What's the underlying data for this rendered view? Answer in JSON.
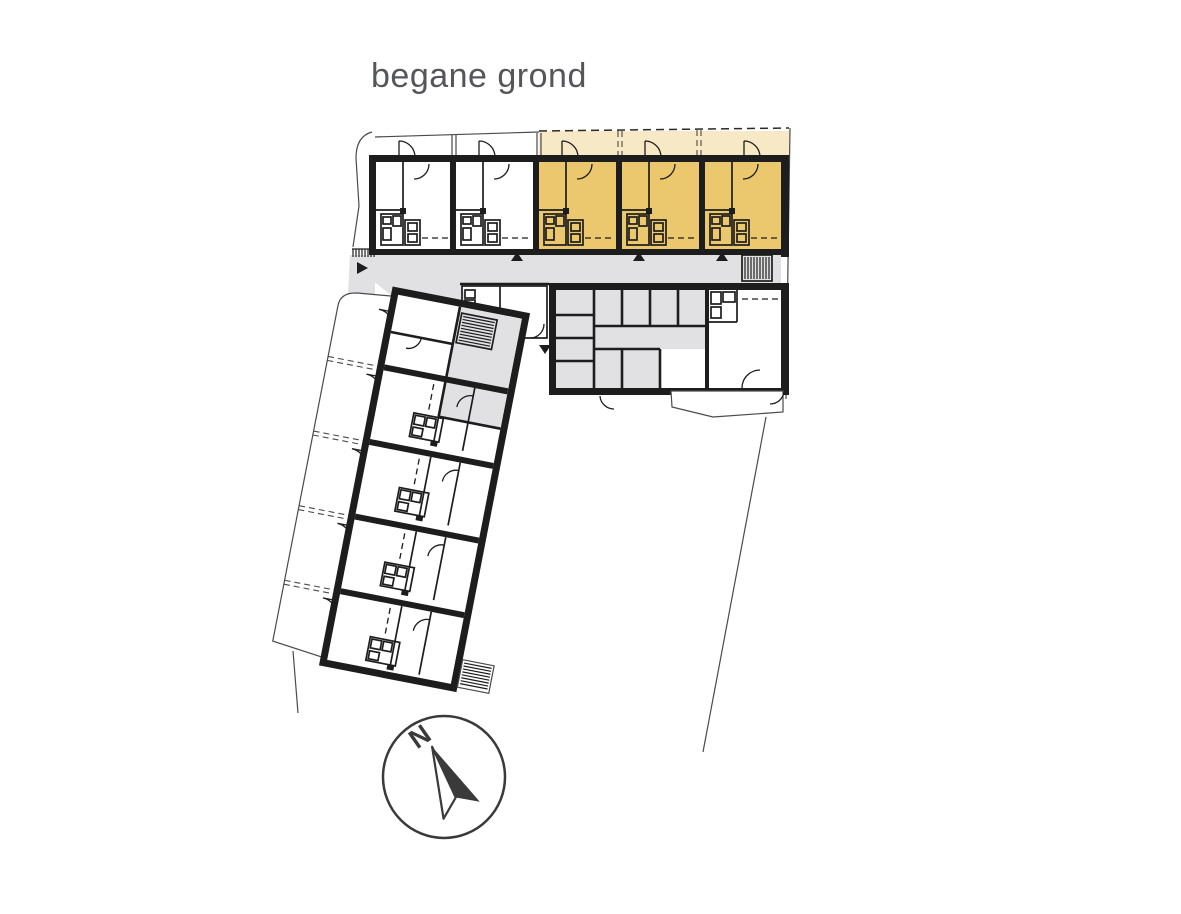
{
  "title": {
    "text": "begane grond"
  },
  "compass": {
    "north_label": "N"
  },
  "colors": {
    "highlight_unit": "#ebc76d",
    "highlight_terrace": "#f7e8c6",
    "circulation": "#e1e1e4",
    "wall": "#1d1d1d",
    "site_line": "#4a4a4a",
    "title_text": "#55565a",
    "compass_stroke": "#3a3a3a"
  },
  "plan": {
    "floor_label": "begane grond",
    "top_wing": {
      "units_total": 5,
      "units_highlighted": 3
    },
    "diagonal_wing": {
      "units_total": 5
    }
  }
}
